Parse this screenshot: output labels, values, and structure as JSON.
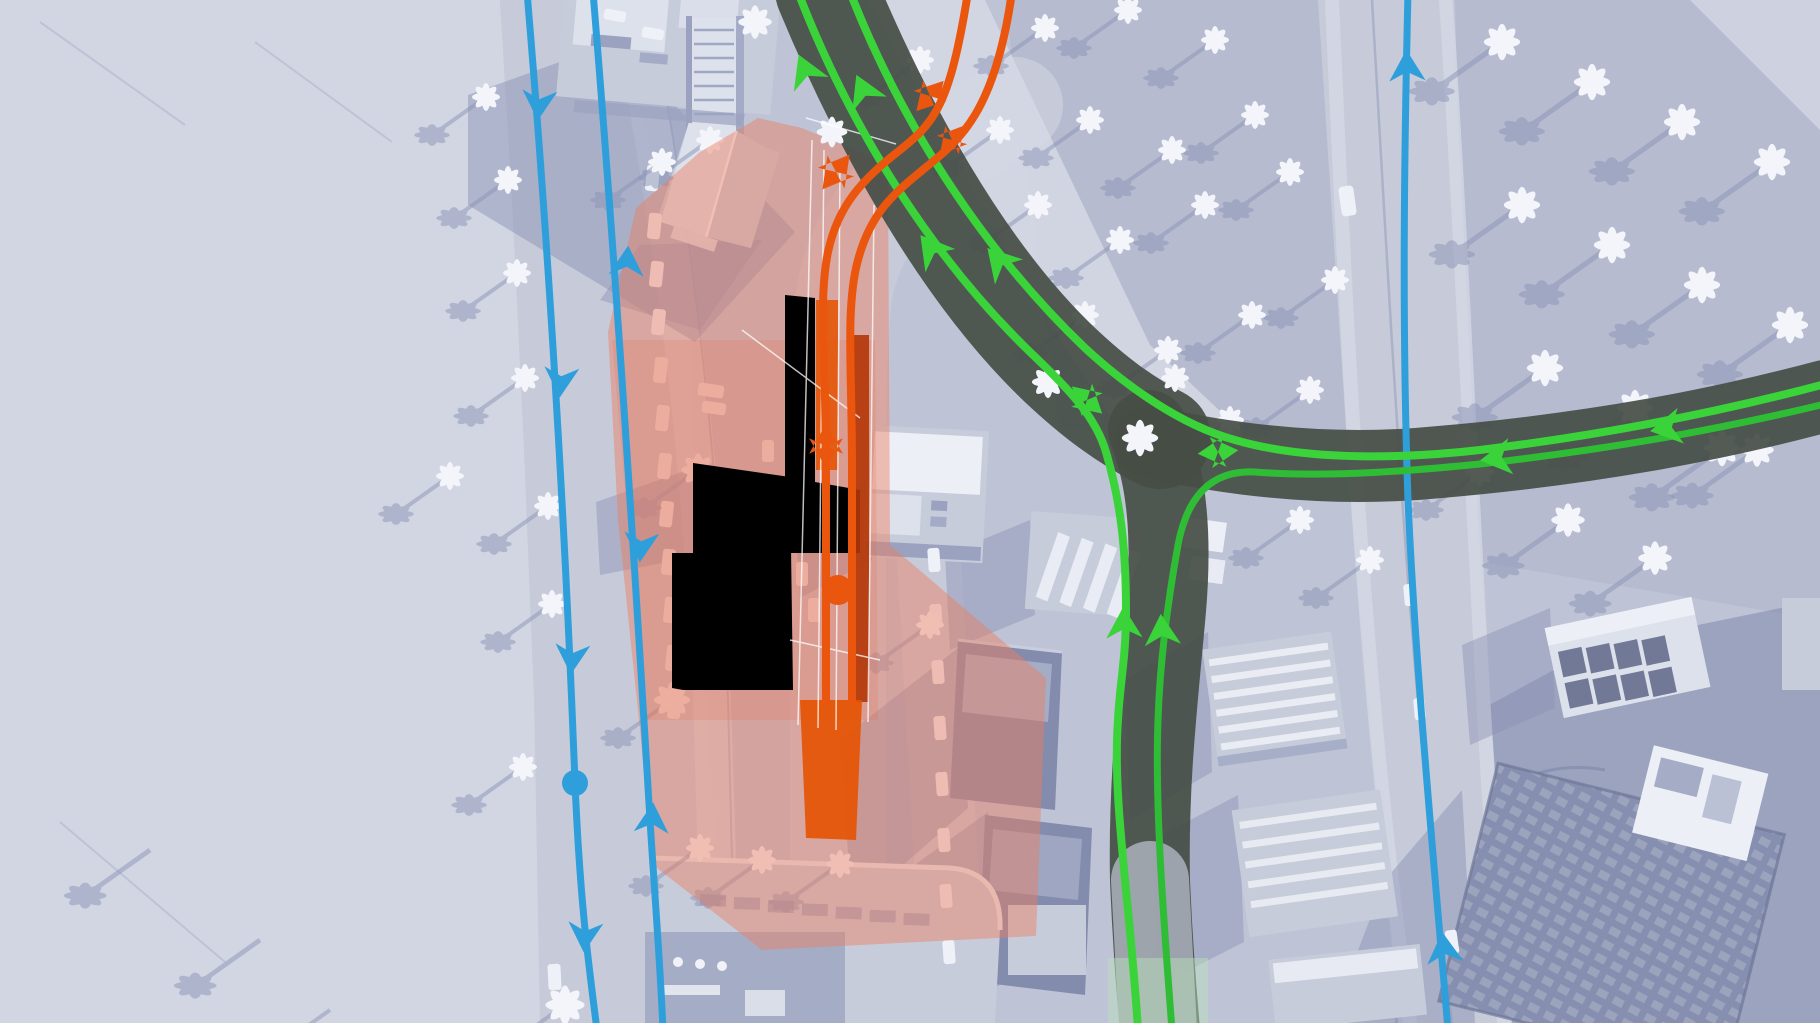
{
  "scene": {
    "type": "city-builder-game-screenshot",
    "view": "traffic-routes-overlay",
    "season": "winter-snow",
    "selected_building_highlighted": true
  },
  "colors": {
    "ground": "#bec4d6",
    "snow": "#d2d6e3",
    "grove": "#aeb5cc",
    "road": "#c7cbd9",
    "road_light": "#d4d8e3",
    "curb": "#9099b8",
    "shadow": "#8b93b6",
    "hill_shadow": "#7f88ab",
    "building_mid": "#c7ccdb",
    "building_light": "#dde1ec",
    "roof_white": "#eceff6",
    "building_dark": "#9aa2c0",
    "tower_dark": "#848cae",
    "tower_mid": "#a5adc6",
    "grid_dark": "#747d9f",
    "tree_white": "#f3f5fa",
    "tree_shadow": "#8b94b6",
    "car_white": "#eef1f7",
    "route_blue": "#2f9fdc",
    "route_green": "#3ad43a",
    "route_green_dim": "#2fbd35",
    "route_orange": "#ea560e",
    "route_node_orange": "#e0560e",
    "road_tint_red": "#b23708",
    "road_tint_orange": "#e55200",
    "elevated_road": "#454d45",
    "elevated_road_pale": "#b8becb",
    "pale_green_wash": "#b9e2ba",
    "selection_zone": "#ee7d5e",
    "selection_zone_inner": "#e56a47",
    "wire_white": "#ffffff"
  },
  "overlay": {
    "selected_building": {
      "name": "selected-building",
      "highlight_color": "#e84c0b"
    },
    "routes": [
      {
        "name": "blue-route",
        "color": "#2f9fdc",
        "has_direction_arrows": true,
        "has_node_dot": true
      },
      {
        "name": "green-route",
        "color": "#3ad43a",
        "has_direction_arrows": true
      },
      {
        "name": "orange-route",
        "color": "#ea560e",
        "has_direction_arrows": true,
        "has_node_dot": true
      }
    ]
  }
}
